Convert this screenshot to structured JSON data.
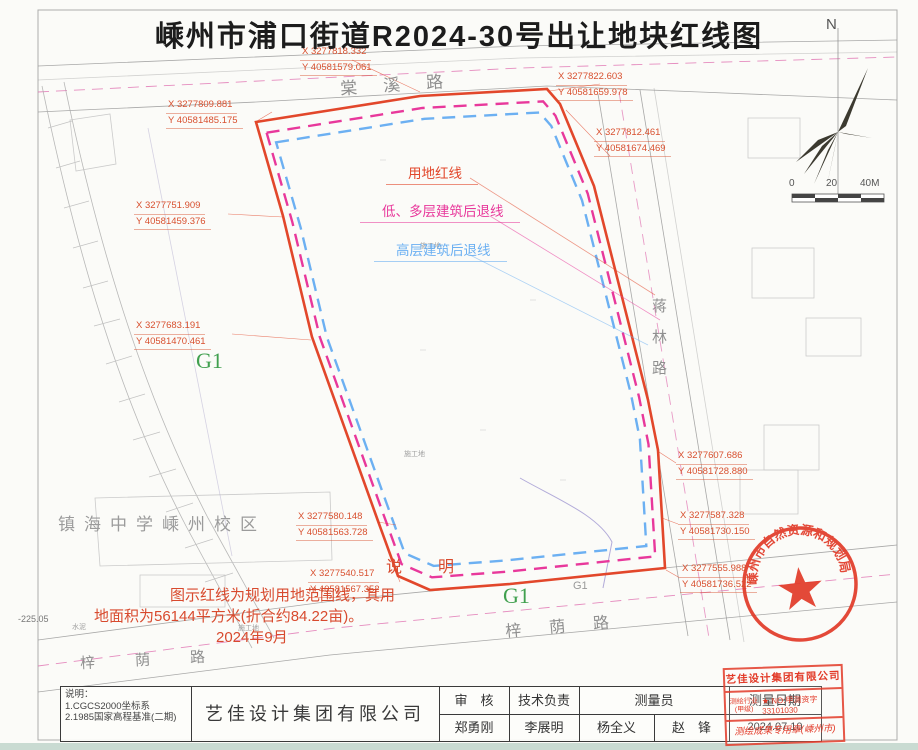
{
  "title": "嵊州市浦口街道R2024-30号出让地块红线图",
  "roads": {
    "top": "棠溪路",
    "right": "蒋林路",
    "bottom": "梓荫路",
    "bottom_left": "梓荫路"
  },
  "legend": {
    "redline": "用地红线",
    "low_setback": "低、多层建筑后退线",
    "high_setback": "高层建筑后退线"
  },
  "coords": [
    {
      "x": "X 3277818.332",
      "y": "Y 40581579.061"
    },
    {
      "x": "X 3277809.881",
      "y": "Y 40581485.175"
    },
    {
      "x": "X 3277822.603",
      "y": "Y 40581659.978"
    },
    {
      "x": "X 3277812.461",
      "y": "Y 40581674.469"
    },
    {
      "x": "X 3277751.909",
      "y": "Y 40581459.376"
    },
    {
      "x": "X 3277683.191",
      "y": "Y 40581470.461"
    },
    {
      "x": "X 3277607.686",
      "y": "Y 40581728.880"
    },
    {
      "x": "X 3277587.328",
      "y": "Y 40581730.150"
    },
    {
      "x": "X 3277580.148",
      "y": "Y 40581563.728"
    },
    {
      "x": "X 3277540.517",
      "y": "Y 40581567.352"
    },
    {
      "x": "X 3277555.988",
      "y": "Y 40581736.522"
    }
  ],
  "zones": {
    "g1_left": "G1",
    "g1_bottom": "G1",
    "g1_small": "G1"
  },
  "school": "镇海中学嵊州校区",
  "notes": {
    "heading": "说　明",
    "line1": "图示红线为规划用地范围线，其用",
    "line2": "地面积为56144平方米(折合约84.22亩)。",
    "line3": "2024年9月"
  },
  "misc": {
    "elevation": "-225.05",
    "cement": "水泥",
    "site1": "施工地",
    "site2": "施工地",
    "site3": "施工地"
  },
  "compass": {
    "north": "N"
  },
  "scalebar": {
    "zero": "0",
    "mid": "20",
    "end": "40M"
  },
  "round_stamp": "嵊州市自然资源和规划局",
  "titleblock": {
    "notes_label": "说明：",
    "note1": "1.CGCS2000坐标系",
    "note2": "2.1985国家高程基准(二期)",
    "company": "艺佳设计集团有限公司",
    "col_review": "审　核",
    "col_tech": "技术负责",
    "col_surveyor": "测量员",
    "col_date": "测量日期",
    "reviewer": "郑勇刚",
    "tech": "李展明",
    "surveyor1": "杨全义",
    "surveyor2": "赵　锋",
    "date": "2024.07.10"
  },
  "cert_stamp": {
    "company": "艺佳设计集团有限公司",
    "industry": "测绘行业",
    "grade": "(甲级)",
    "cert_no": "★ NO:甲测资字33101030",
    "seal_name": "测绘成果专用章(嵊州市)"
  },
  "colors": {
    "redline": "#e2472b",
    "setback_low": "#e8389b",
    "setback_high": "#6cb0f2",
    "stamp_red": "#e23a28",
    "zone_green": "#41a04f"
  }
}
